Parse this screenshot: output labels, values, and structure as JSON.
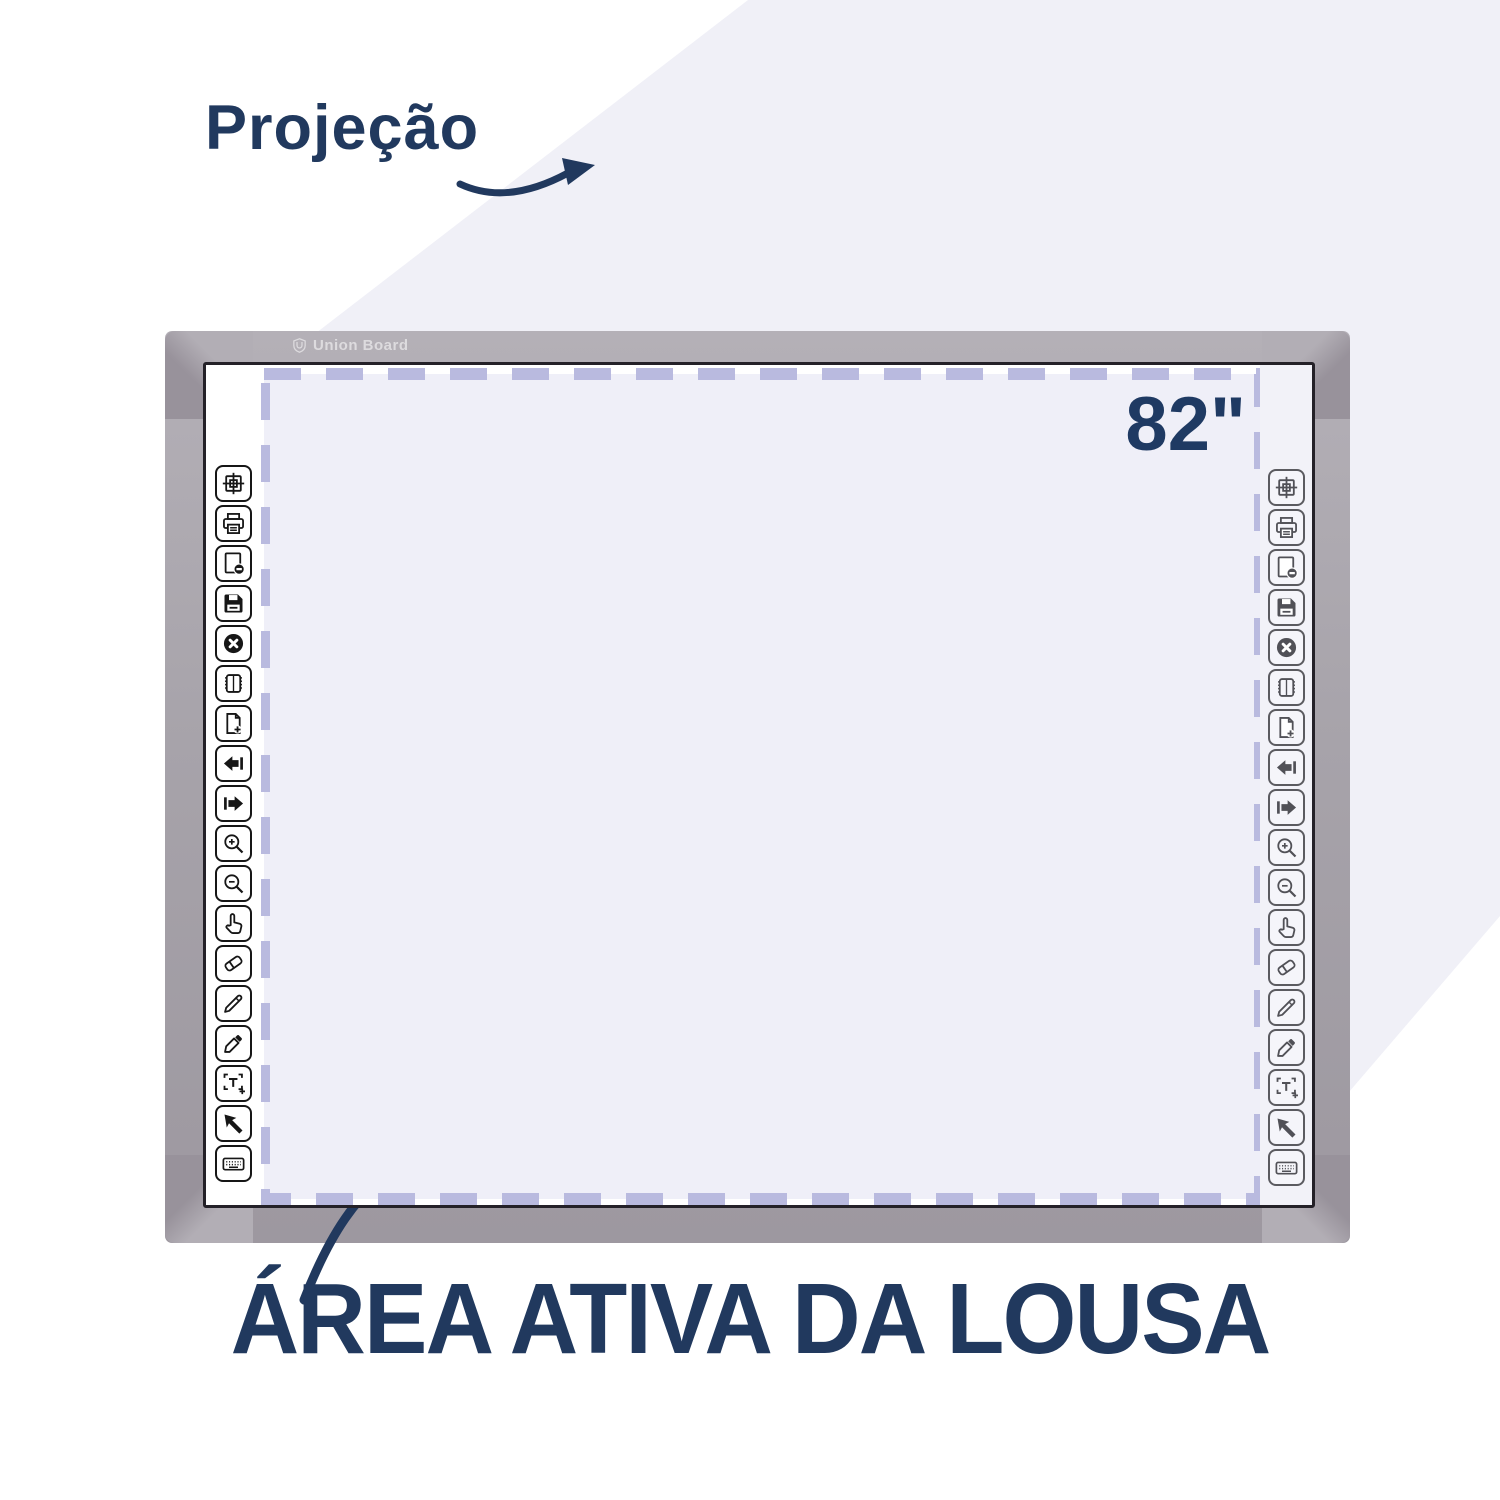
{
  "labels": {
    "projection": "Projeção",
    "size": "82\"",
    "active_area": "ÁREA ATIVA DA LOUSA"
  },
  "brand": {
    "name": "Union Board"
  },
  "toolbar": {
    "icons": [
      {
        "name": "calibrate-icon"
      },
      {
        "name": "print-icon"
      },
      {
        "name": "page-remove-icon"
      },
      {
        "name": "save-icon"
      },
      {
        "name": "close-icon"
      },
      {
        "name": "notebook-icon"
      },
      {
        "name": "page-add-icon"
      },
      {
        "name": "previous-icon"
      },
      {
        "name": "next-icon"
      },
      {
        "name": "zoom-in-icon"
      },
      {
        "name": "zoom-out-icon"
      },
      {
        "name": "pan-icon"
      },
      {
        "name": "eraser-icon"
      },
      {
        "name": "pencil-icon"
      },
      {
        "name": "highlighter-icon"
      },
      {
        "name": "text-icon"
      },
      {
        "name": "select-icon"
      },
      {
        "name": "keyboard-icon"
      }
    ]
  },
  "colors": {
    "accent_navy": "#21395e",
    "frame_gray": "#a7a3aa",
    "frame_corner_gray": "#98929b",
    "dash_lavender": "#b9badf",
    "background_lavender": "#f0f0f7",
    "projection_fill": "#efeff8",
    "board_white": "#ffffff"
  }
}
